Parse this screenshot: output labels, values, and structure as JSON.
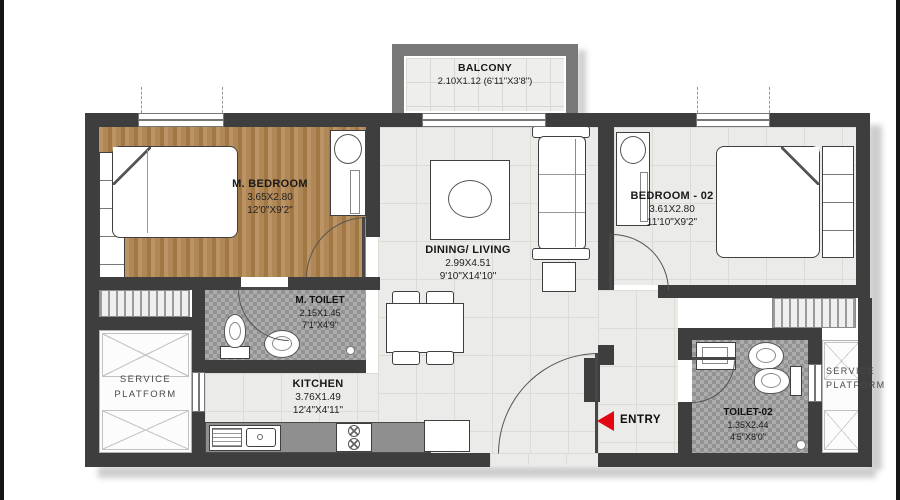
{
  "rooms": {
    "balcony": {
      "name": "BALCONY",
      "dims": "2.10X1.12 (6'11\"X3'8\")"
    },
    "m_bedroom": {
      "name": "M. BEDROOM",
      "dims_m": "3.65X2.80",
      "dims_ft": "12'0\"X9'2\""
    },
    "bedroom_02": {
      "name": "BEDROOM - 02",
      "dims_m": "3.61X2.80",
      "dims_ft": "11'10\"X9'2\""
    },
    "dining_living": {
      "name": "DINING/ LIVING",
      "dims_m": "2.99X4.51",
      "dims_ft": "9'10\"X14'10\""
    },
    "m_toilet": {
      "name": "M. TOILET",
      "dims_m": "2.15X1.45",
      "dims_ft": "7'1\"X4'9\""
    },
    "kitchen": {
      "name": "KITCHEN",
      "dims_m": "3.76X1.49",
      "dims_ft": "12'4\"X4'11\""
    },
    "toilet_02": {
      "name": "TOILET-02",
      "dims_m": "1.35X2.44",
      "dims_ft": "4'5\"X8'0\""
    },
    "service_platform_left": {
      "line1": "SERVICE",
      "line2": "PLATFORM"
    },
    "service_platform_right": {
      "line1": "SERVICE",
      "line2": "PLATFORM"
    }
  },
  "entry": {
    "label": "ENTRY",
    "arrow_color": "#e30613"
  },
  "palette": {
    "wall": "#3e3e3e",
    "wood_floor": "#b28a58",
    "tile_floor": "#ebebe9",
    "mosaic_floor": "#acacac",
    "balcony_wall": "#787878"
  }
}
